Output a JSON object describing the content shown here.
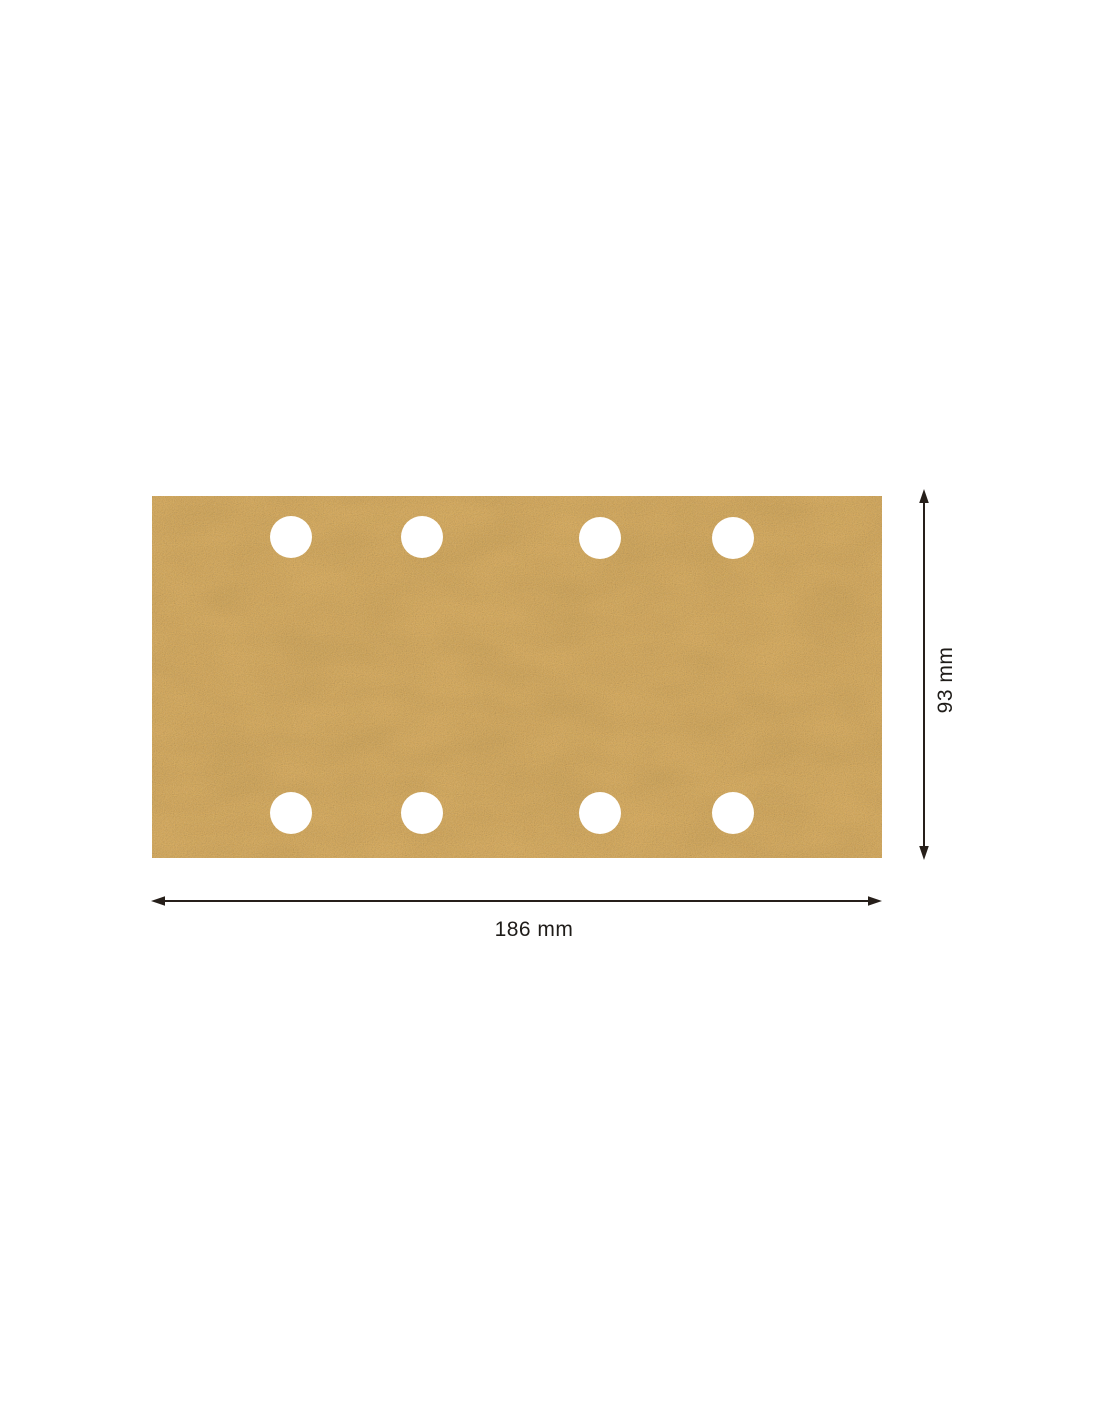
{
  "page": {
    "background_color": "#ffffff"
  },
  "diagram": {
    "sheet": {
      "fill_color": "#dfb05d",
      "hole_fill_color": "#ffffff",
      "hole_count": 8
    },
    "dimensions": {
      "width_label": "186 mm",
      "height_label": "93 mm",
      "line_color": "#261f1a",
      "label_color": "#1f1c19"
    }
  }
}
